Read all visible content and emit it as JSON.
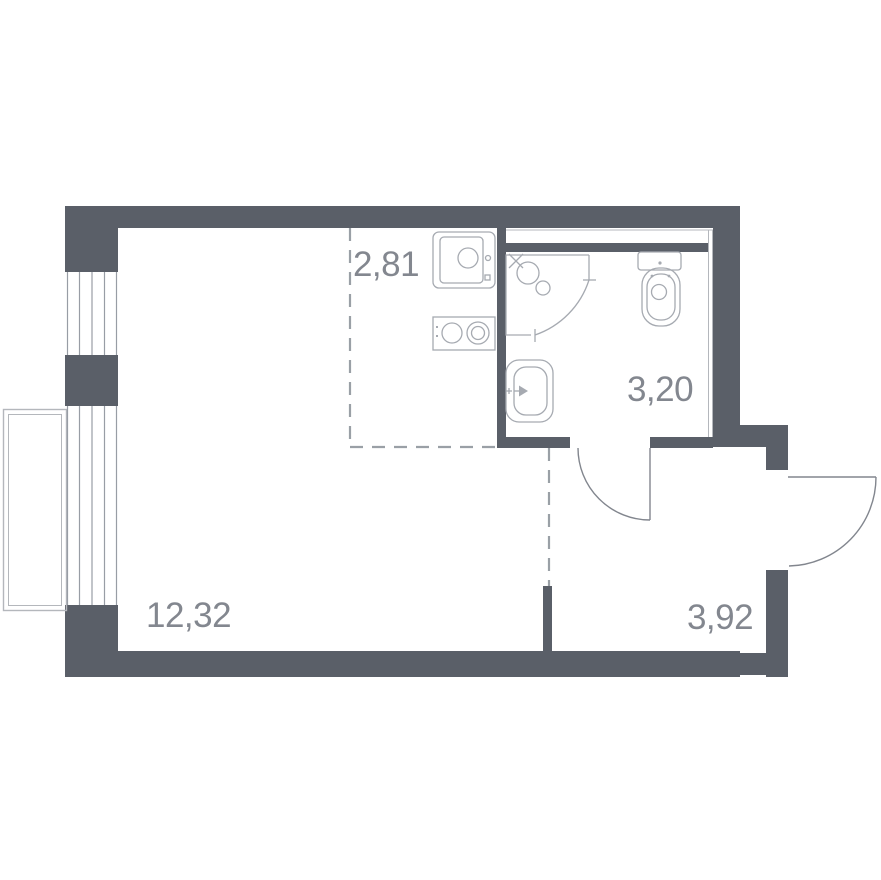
{
  "plan": {
    "type": "floor-plan",
    "rooms": {
      "kitchen": {
        "area": "2,81"
      },
      "bathroom": {
        "area": "3,20"
      },
      "main_room": {
        "area": "12,32"
      },
      "hallway": {
        "area": "3,92"
      }
    },
    "colors": {
      "wall": "#5a5f68",
      "line_light": "#b4b7bc",
      "fixture": "#a6aab1",
      "door": "#82868e",
      "dash": "#9aa0a6",
      "label": "#83878f",
      "background": "#ffffff"
    }
  }
}
